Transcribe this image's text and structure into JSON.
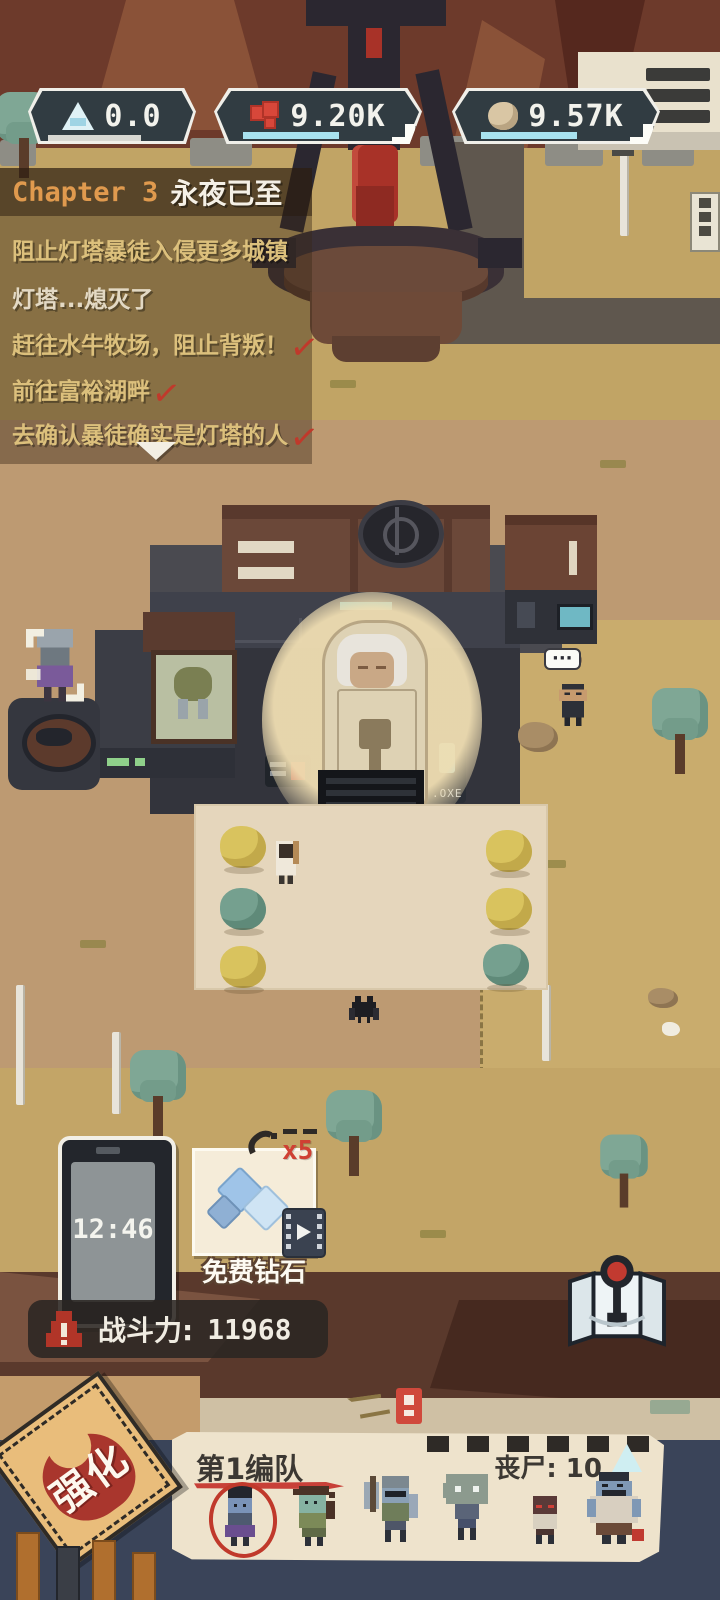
{
  "resources": {
    "energy": {
      "value": "0.0"
    },
    "gems": {
      "value": "9.20K",
      "add_label": ""
    },
    "stone": {
      "value": "9.57K",
      "add_label": ""
    }
  },
  "quest_panel": {
    "chapter_label": "Chapter 3",
    "chapter_title": "永夜已至",
    "quests": [
      {
        "text": "阻止灯塔暴徒入侵更多城镇"
      },
      {
        "text": "灯塔...熄灭了"
      },
      {
        "text": "赶往水牛牧场，阻止背叛！",
        "check": "✓"
      },
      {
        "text": "前往富裕湖畔",
        "check": "✓"
      },
      {
        "text": "去确认暴徒确实是灯塔的人",
        "check": "✓"
      }
    ]
  },
  "scene": {
    "machine_label": ".OXE",
    "npc_bubble": "···"
  },
  "clock": {
    "time": "12:46"
  },
  "free_diamonds": {
    "label": "免费钻石",
    "multiplier": "x5"
  },
  "combat_power": {
    "label": "战斗力:",
    "value": "11968"
  },
  "squad_panel": {
    "title": "第1编队",
    "zombie_count_label": "丧尸: 10"
  },
  "enhance_stamp": {
    "label": "强化"
  },
  "colors": {
    "accent_cyan": "#a8e2ef",
    "check_red": "#c0392b",
    "chapter_orange": "#e09a4e",
    "paper": "#eee3cc",
    "navy": "#3a4459"
  }
}
